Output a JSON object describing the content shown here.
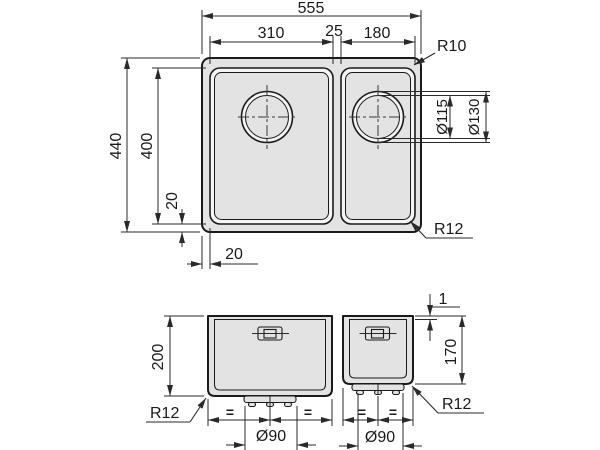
{
  "views": {
    "top": {
      "dim_overall_width": "555",
      "dim_bowl1_width": "310",
      "dim_gap": "25",
      "dim_bowl2_width": "180",
      "label_corner_radius_outer": "R10",
      "label_drain_inner_dia": "Ø115",
      "label_drain_outer_dia": "Ø130",
      "dim_overall_depth": "440",
      "dim_bowl_depth": "400",
      "dim_bowl_bottom_offset": "20",
      "dim_bowl_left_offset": "20",
      "label_corner_radius_bowl": "R12"
    },
    "front": {
      "dim_bowl1_height": "200",
      "dim_rim_thickness": "1",
      "dim_bowl2_height": "170",
      "label_radius_bowl1": "R12",
      "label_radius_bowl2": "R12",
      "dim_drain1_dia": "Ø90",
      "dim_drain2_dia": "Ø90",
      "symbol_equal": "="
    }
  },
  "colors": {
    "line": "#1a1a1a",
    "dim_line": "#2a2a2a",
    "fill_body": "#e3e3e3",
    "fill_rim": "#f4f4f4",
    "background": "#ffffff"
  }
}
